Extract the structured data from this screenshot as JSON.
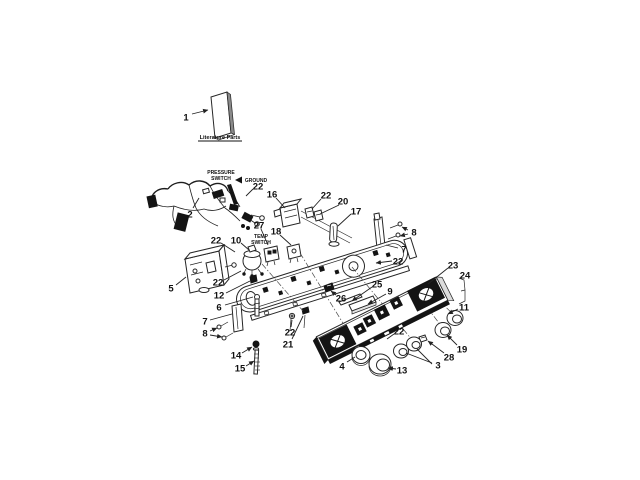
{
  "page": {
    "background": "#ffffff",
    "width": 640,
    "height": 480
  },
  "diagram": {
    "kind": "exploded-parts-diagram",
    "line_color": "#222222",
    "dark_fill": "#141414",
    "text_color": "#111111",
    "literature_label": "Literature Parts",
    "annotations": [
      {
        "id": "pressure-switch-label",
        "lines": [
          "PRESSURE",
          "SWITCH"
        ],
        "x": 221,
        "y": 174,
        "line_h": 6
      },
      {
        "id": "ground-label",
        "lines": [
          "GROUND"
        ],
        "x": 256,
        "y": 182,
        "line_h": 6
      },
      {
        "id": "temp-switch-label",
        "lines": [
          "TEMP",
          "SWITCH"
        ],
        "x": 261,
        "y": 238,
        "line_h": 6
      }
    ],
    "callouts": [
      {
        "label": "1",
        "x": 186,
        "y": 117,
        "leaders": [
          {
            "x1": 192,
            "y1": 114,
            "x2": 208,
            "y2": 110,
            "arrow": true
          }
        ]
      },
      {
        "label": "2",
        "x": 190,
        "y": 214,
        "leaders": [
          {
            "x1": 193,
            "y1": 208,
            "x2": 199,
            "y2": 198,
            "arrow": false
          }
        ]
      },
      {
        "label": "22",
        "x": 258,
        "y": 186,
        "leaders": [
          {
            "x1": 253,
            "y1": 189,
            "x2": 246,
            "y2": 196,
            "arrow": false
          }
        ]
      },
      {
        "label": "16",
        "x": 272,
        "y": 194,
        "leaders": [
          {
            "x1": 276,
            "y1": 198,
            "x2": 285,
            "y2": 208,
            "arrow": false
          }
        ]
      },
      {
        "label": "22",
        "x": 326,
        "y": 195,
        "leaders": [
          {
            "x1": 321,
            "y1": 199,
            "x2": 312,
            "y2": 209,
            "arrow": false
          }
        ]
      },
      {
        "label": "20",
        "x": 343,
        "y": 201,
        "leaders": [
          {
            "x1": 339,
            "y1": 205,
            "x2": 320,
            "y2": 214,
            "arrow": false
          }
        ]
      },
      {
        "label": "17",
        "x": 356,
        "y": 211,
        "leaders": [
          {
            "x1": 351,
            "y1": 214,
            "x2": 338,
            "y2": 226,
            "arrow": false
          }
        ]
      },
      {
        "label": "8",
        "x": 414,
        "y": 232,
        "leaders": [
          {
            "x1": 408,
            "y1": 230,
            "x2": 402,
            "y2": 227,
            "arrow": true
          },
          {
            "x1": 408,
            "y1": 234,
            "x2": 400,
            "y2": 236,
            "arrow": true
          }
        ]
      },
      {
        "label": "7",
        "x": 404,
        "y": 249,
        "leaders": [
          {
            "x1": 398,
            "y1": 248,
            "x2": 386,
            "y2": 245,
            "arrow": false
          }
        ]
      },
      {
        "label": "22",
        "x": 398,
        "y": 261,
        "leaders": [
          {
            "x1": 392,
            "y1": 261,
            "x2": 376,
            "y2": 263,
            "arrow": true
          }
        ]
      },
      {
        "label": "27",
        "x": 259,
        "y": 225,
        "leaders": [
          {
            "x1": 261,
            "y1": 229,
            "x2": 268,
            "y2": 245,
            "arrow": false
          }
        ]
      },
      {
        "label": "18",
        "x": 276,
        "y": 231,
        "leaders": [
          {
            "x1": 280,
            "y1": 235,
            "x2": 291,
            "y2": 245,
            "arrow": false
          }
        ]
      },
      {
        "label": "22",
        "x": 216,
        "y": 240,
        "leaders": [
          {
            "x1": 221,
            "y1": 243,
            "x2": 235,
            "y2": 252,
            "arrow": false
          }
        ]
      },
      {
        "label": "10",
        "x": 236,
        "y": 240,
        "leaders": [
          {
            "x1": 241,
            "y1": 243,
            "x2": 249,
            "y2": 250,
            "arrow": false
          }
        ]
      },
      {
        "label": "5",
        "x": 171,
        "y": 288,
        "leaders": [
          {
            "x1": 176,
            "y1": 285,
            "x2": 186,
            "y2": 277,
            "arrow": false
          }
        ]
      },
      {
        "label": "22",
        "x": 218,
        "y": 282,
        "leaders": [
          {
            "x1": 224,
            "y1": 280,
            "x2": 241,
            "y2": 271,
            "arrow": false
          }
        ]
      },
      {
        "label": "12",
        "x": 219,
        "y": 295,
        "leaders": [
          {
            "x1": 226,
            "y1": 293,
            "x2": 250,
            "y2": 281,
            "arrow": false
          }
        ]
      },
      {
        "label": "6",
        "x": 219,
        "y": 307,
        "leaders": [
          {
            "x1": 225,
            "y1": 305,
            "x2": 253,
            "y2": 297,
            "arrow": false
          }
        ]
      },
      {
        "label": "7",
        "x": 205,
        "y": 321,
        "leaders": [
          {
            "x1": 210,
            "y1": 320,
            "x2": 232,
            "y2": 314,
            "arrow": false
          }
        ]
      },
      {
        "label": "8",
        "x": 205,
        "y": 333,
        "leaders": [
          {
            "x1": 210,
            "y1": 331,
            "x2": 217,
            "y2": 328,
            "arrow": true
          },
          {
            "x1": 210,
            "y1": 335,
            "x2": 222,
            "y2": 337,
            "arrow": true
          }
        ]
      },
      {
        "label": "14",
        "x": 236,
        "y": 355,
        "leaders": [
          {
            "x1": 242,
            "y1": 353,
            "x2": 252,
            "y2": 347,
            "arrow": true
          }
        ]
      },
      {
        "label": "15",
        "x": 240,
        "y": 368,
        "leaders": [
          {
            "x1": 246,
            "y1": 366,
            "x2": 254,
            "y2": 361,
            "arrow": true
          }
        ]
      },
      {
        "label": "22",
        "x": 290,
        "y": 332,
        "leaders": [
          {
            "x1": 291,
            "y1": 327,
            "x2": 292,
            "y2": 320,
            "arrow": false
          }
        ]
      },
      {
        "label": "21",
        "x": 288,
        "y": 344,
        "leaders": [
          {
            "x1": 292,
            "y1": 339,
            "x2": 303,
            "y2": 316,
            "arrow": false
          }
        ]
      },
      {
        "label": "26",
        "x": 341,
        "y": 298,
        "leaders": [
          {
            "x1": 336,
            "y1": 295,
            "x2": 331,
            "y2": 291,
            "arrow": true
          }
        ]
      },
      {
        "label": "25",
        "x": 377,
        "y": 284,
        "leaders": [
          {
            "x1": 372,
            "y1": 287,
            "x2": 352,
            "y2": 301,
            "arrow": true
          }
        ]
      },
      {
        "label": "9",
        "x": 390,
        "y": 291,
        "leaders": [
          {
            "x1": 386,
            "y1": 294,
            "x2": 368,
            "y2": 304,
            "arrow": true
          }
        ]
      },
      {
        "label": "23",
        "x": 453,
        "y": 265,
        "leaders": [
          {
            "x1": 448,
            "y1": 268,
            "x2": 428,
            "y2": 284,
            "arrow": false
          }
        ]
      },
      {
        "label": "24",
        "x": 465,
        "y": 275,
        "leaders": []
      },
      {
        "label": "11",
        "x": 464,
        "y": 307,
        "leaders": [
          {
            "x1": 458,
            "y1": 309,
            "x2": 448,
            "y2": 314,
            "arrow": true
          }
        ]
      },
      {
        "label": "19",
        "x": 462,
        "y": 349,
        "leaders": [
          {
            "x1": 457,
            "y1": 345,
            "x2": 447,
            "y2": 335,
            "arrow": true
          }
        ]
      },
      {
        "label": "28",
        "x": 449,
        "y": 357,
        "leaders": [
          {
            "x1": 444,
            "y1": 353,
            "x2": 428,
            "y2": 341,
            "arrow": true
          }
        ]
      },
      {
        "label": "3",
        "x": 438,
        "y": 365,
        "leaders": [
          {
            "x1": 432,
            "y1": 363,
            "x2": 406,
            "y2": 353,
            "arrow": false
          },
          {
            "x1": 432,
            "y1": 364,
            "x2": 417,
            "y2": 349,
            "arrow": false
          }
        ]
      },
      {
        "label": "13",
        "x": 402,
        "y": 370,
        "leaders": [
          {
            "x1": 396,
            "y1": 369,
            "x2": 388,
            "y2": 368,
            "arrow": true
          }
        ]
      },
      {
        "label": "4",
        "x": 342,
        "y": 366,
        "leaders": [
          {
            "x1": 347,
            "y1": 362,
            "x2": 355,
            "y2": 357,
            "arrow": false
          }
        ]
      },
      {
        "label": "22",
        "x": 399,
        "y": 331,
        "leaders": [
          {
            "x1": 394,
            "y1": 334,
            "x2": 387,
            "y2": 339,
            "arrow": false
          }
        ]
      }
    ]
  }
}
